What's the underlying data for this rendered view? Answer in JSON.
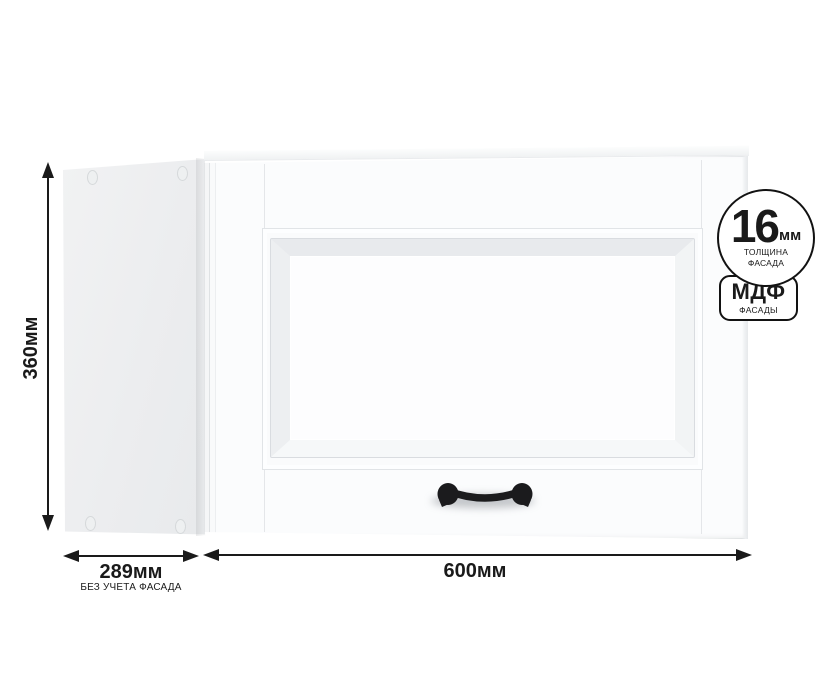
{
  "product": {
    "type": "wall-cabinet-render",
    "dimensions": {
      "height": "360мм",
      "depth": "289мм",
      "depth_note": "БЕЗ УЧЕТА ФАСАДА",
      "width": "600мм"
    },
    "badges": {
      "thickness": {
        "value": "16",
        "unit": "мм",
        "caption_line1": "ТОЛЩИНА",
        "caption_line2": "ФАСАДА"
      },
      "material": {
        "name": "МДФ",
        "caption": "ФАСАДЫ"
      }
    },
    "colors": {
      "background": "#ffffff",
      "dimension_lines": "#1a1a1a",
      "badge_border": "#121212",
      "handle": "#1b1b1d",
      "side_panel": "#ededef",
      "door_face": "#fbfcfd"
    }
  }
}
